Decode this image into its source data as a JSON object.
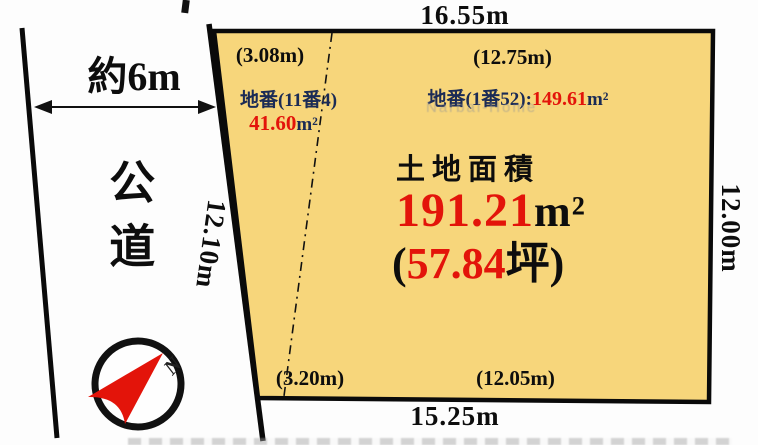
{
  "colors": {
    "parcel_fill": "#F7D67B",
    "outline": "#0a0a0a",
    "accent_red": "#E3140A",
    "accent_navy": "#1B2B55"
  },
  "dimensions": {
    "top": "16.55m",
    "bottom": "15.25m",
    "right": "12.00m",
    "left": "12.10m"
  },
  "road": {
    "name": "公道",
    "width": "約6m"
  },
  "left_section": {
    "top_dim": "(3.08m)",
    "bottom_dim": "(3.20m)",
    "lot_label": "地番(11番4)",
    "area_value": "41.60",
    "area_unit": "m²"
  },
  "right_section": {
    "top_dim": "(12.75m)",
    "bottom_dim": "(12.05m)",
    "lot_label": "地番(1番52):",
    "area_value": "149.61",
    "area_unit": "m²"
  },
  "total": {
    "heading": "土地面積",
    "area_value": "191.21",
    "area_unit": "m²",
    "tsubo_prefix": "(",
    "tsubo_value": "57.84",
    "tsubo_suffix": "坪)"
  },
  "compass": {
    "north_label": "N"
  },
  "watermark": "Narbal-Home"
}
